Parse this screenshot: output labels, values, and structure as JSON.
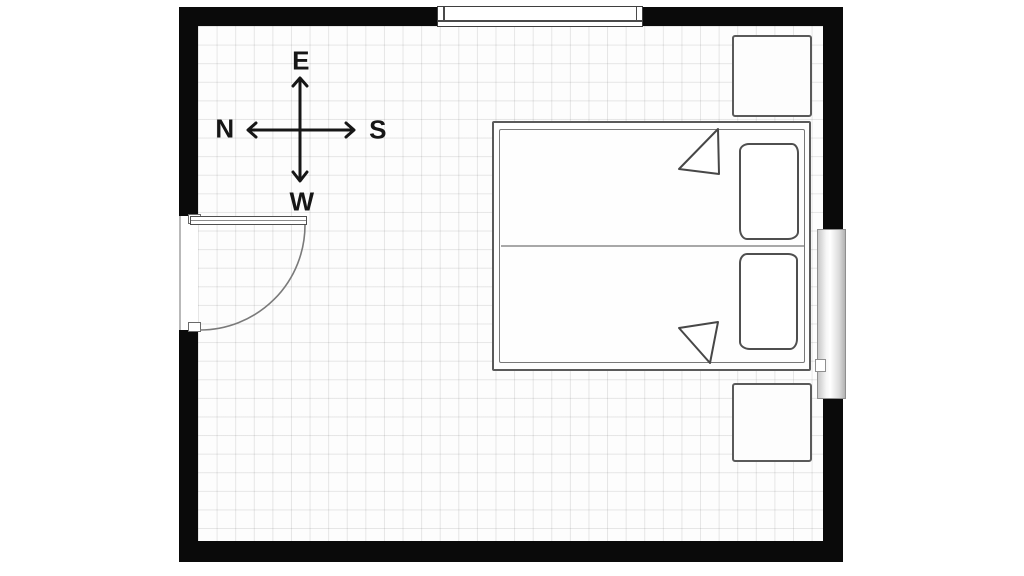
{
  "plan": {
    "type": "bedroom-floor-plan"
  },
  "compass": {
    "top": "E",
    "left": "N",
    "right": "S",
    "bottom": "W"
  },
  "colors": {
    "wall": "#0a0a0a",
    "floor": "#fdfdfd",
    "grid_line": "#dedede",
    "furniture_outline": "#4f4f4f",
    "compass": "#161616",
    "page_background": "#ffffff"
  },
  "elements": {
    "walls": "room-walls",
    "door": "hinged-door-left-wall",
    "windows": [
      "window-top-wall",
      "window-right-wall"
    ],
    "bed": "double-bed",
    "pillows": [
      "pillow-top",
      "pillow-bottom"
    ],
    "blanket_folds": [
      "fold-top",
      "fold-bottom"
    ],
    "nightstands": [
      "nightstand-top-right",
      "nightstand-bottom-right"
    ]
  }
}
